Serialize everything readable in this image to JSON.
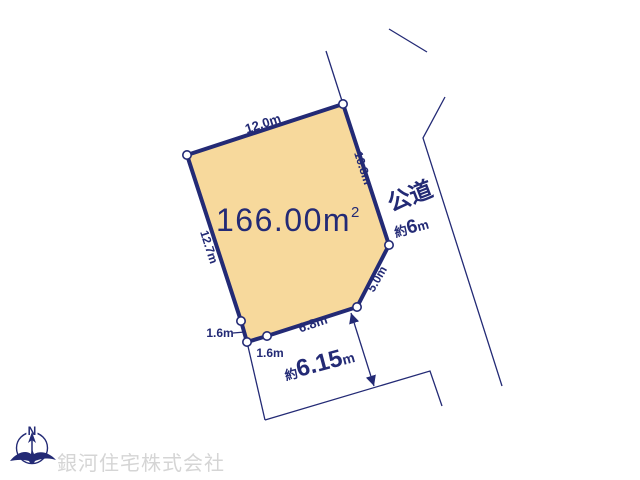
{
  "colors": {
    "line": "#232a75",
    "plot_fill": "#f7d99c",
    "watermark": "#d5d5d5"
  },
  "plot": {
    "area_value": "166.00",
    "area_unit": "m",
    "area_exponent": "2",
    "dimensions": {
      "top": "12.0m",
      "right_upper": "10.8m",
      "right_lower": "5.0m",
      "bottom": "6.8m",
      "bottom_left": "1.6m",
      "bevel": "1.6m",
      "left": "12.7m"
    }
  },
  "road": {
    "name": "公道",
    "width_prefix": "約",
    "width_value": "6",
    "width_unit": "m",
    "frontage_prefix": "約",
    "frontage_value": "6.15",
    "frontage_unit": "m"
  },
  "compass": {
    "north": "N"
  },
  "watermark": {
    "company": "銀河住宅株式会社"
  }
}
